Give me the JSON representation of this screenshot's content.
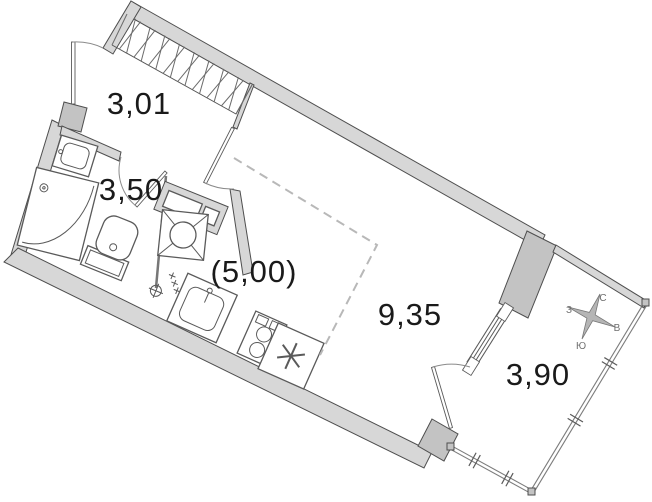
{
  "plan": {
    "rooms": [
      {
        "name": "hallway",
        "area_label": "3,01"
      },
      {
        "name": "bathroom",
        "area_label": "3,50"
      },
      {
        "name": "kitchen-zone",
        "area_label": "(5,00)"
      },
      {
        "name": "living-room",
        "area_label": "9,35"
      },
      {
        "name": "balcony",
        "area_label": "3,90"
      }
    ],
    "compass": {
      "north": "С",
      "south": "Ю",
      "west": "З",
      "east": "В"
    },
    "colors": {
      "background": "#ffffff",
      "wall_fill": "#d7d7d7",
      "wall_dark": "#c3c3c3",
      "outline": "#4e4e4e",
      "fixture": "#5a5a5a",
      "glazing": "#7c7c7c",
      "dashed_zone": "#b8b8b8",
      "label_text": "#1a1a1a",
      "compass_text": "#6e6e6e"
    }
  }
}
